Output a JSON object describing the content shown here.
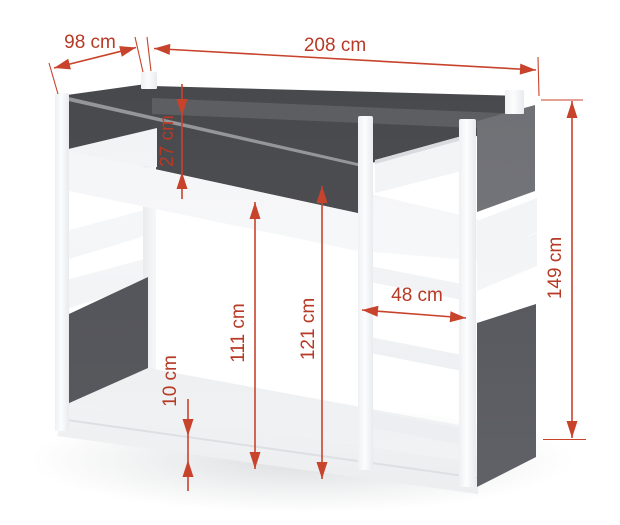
{
  "diagram": {
    "type": "furniture dimension diagram",
    "subject": "bunk bed",
    "accent_color": "#c8432c",
    "label_color": "#b73a26",
    "bed_colors": {
      "frame_white": "#fbfcfd",
      "panel_dark": "#4c4d51",
      "panel_right_upper": "#75767b"
    },
    "dimensions": [
      {
        "id": "depth",
        "label": "98 cm",
        "orientation": "diagonal-top-left"
      },
      {
        "id": "length",
        "label": "208 cm",
        "orientation": "horizontal-top"
      },
      {
        "id": "guard_rail_height",
        "label": "27 cm",
        "orientation": "vertical"
      },
      {
        "id": "overall_height",
        "label": "149 cm",
        "orientation": "vertical-right"
      },
      {
        "id": "ladder_clear_width",
        "label": "48 cm",
        "orientation": "horizontal"
      },
      {
        "id": "clearance_above_mattress",
        "label": "111 cm",
        "orientation": "vertical"
      },
      {
        "id": "clearance_under_frame",
        "label": "121 cm",
        "orientation": "vertical"
      },
      {
        "id": "base_height",
        "label": "10 cm",
        "orientation": "vertical"
      }
    ]
  }
}
